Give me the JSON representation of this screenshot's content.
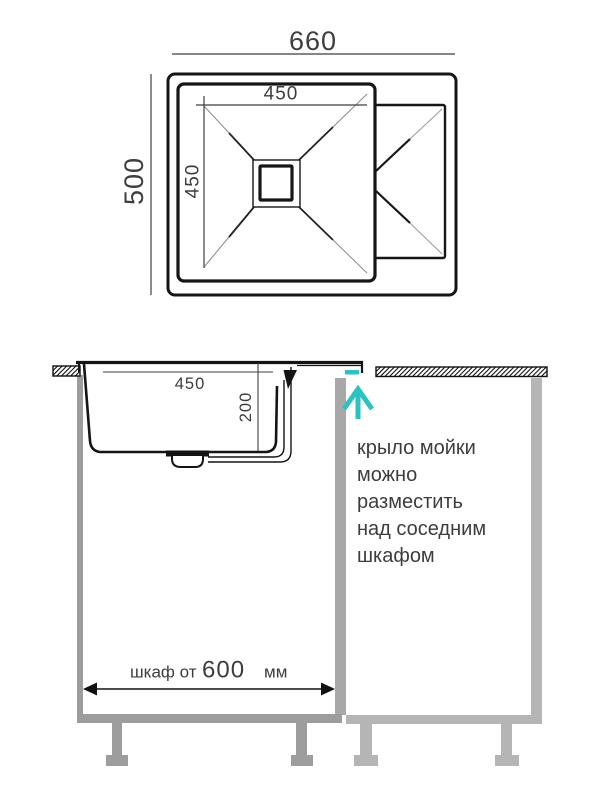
{
  "drawing": {
    "title_hint": "sink installation diagram",
    "top_view": {
      "overall_width": "660",
      "overall_depth": "500",
      "bowl_width": "450",
      "bowl_depth": "450"
    },
    "section_view": {
      "bowl_width": "450",
      "bowl_depth": "200",
      "cabinet_dim_prefix": "шкаф от",
      "cabinet_dim_value": "600",
      "cabinet_dim_unit": "мм",
      "note_lines": [
        "крыло мойки",
        "можно",
        "разместить",
        "над соседним",
        "шкафом"
      ]
    },
    "colors": {
      "accent": "#2bc2c1",
      "line": "#161616",
      "dim_text": "#3d3d3d",
      "cabinet_left": "#9d9d9d",
      "cabinet_mid": "#a8a8a8",
      "cabinet_right": "#b5b5b5"
    }
  }
}
